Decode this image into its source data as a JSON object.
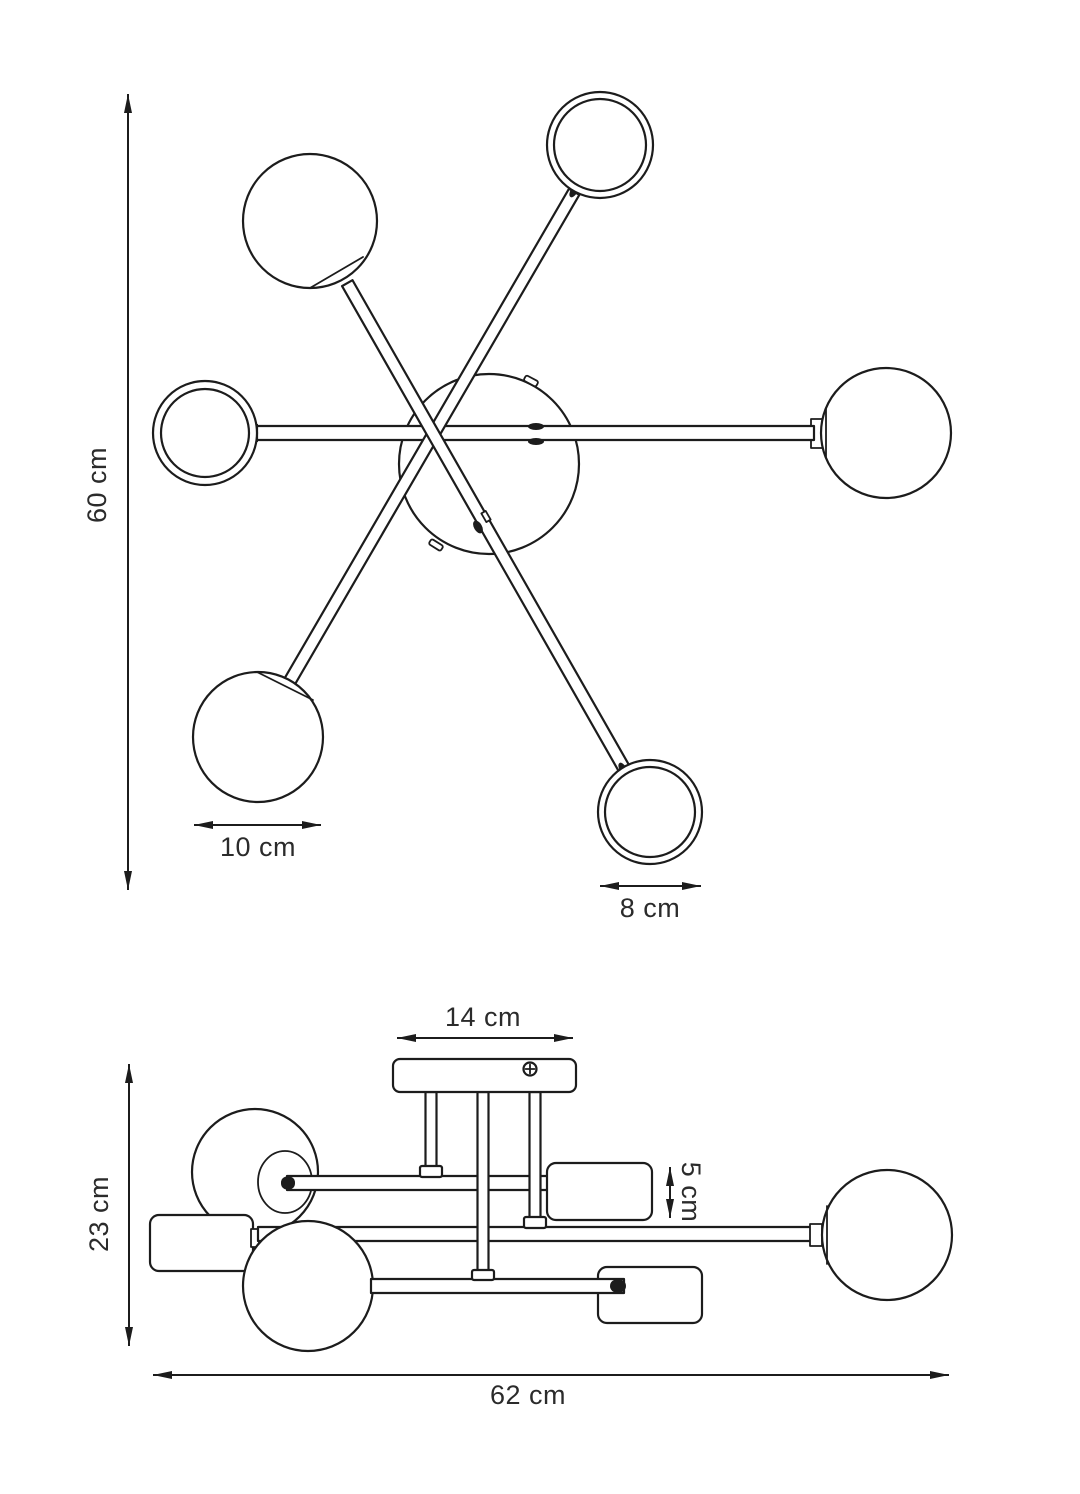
{
  "drawing": {
    "line_color": "#1c1c1c",
    "background": "#ffffff",
    "subject": "ceiling-lamp-technical-drawing"
  },
  "top_view": {
    "dim_height": "60 cm",
    "dim_sphere_diameter": "10 cm",
    "dim_ring_diameter": "8 cm"
  },
  "side_view": {
    "dim_canopy_width": "14 cm",
    "dim_shade_height": "5 cm",
    "dim_total_height": "23 cm",
    "dim_total_width": "62 cm"
  }
}
